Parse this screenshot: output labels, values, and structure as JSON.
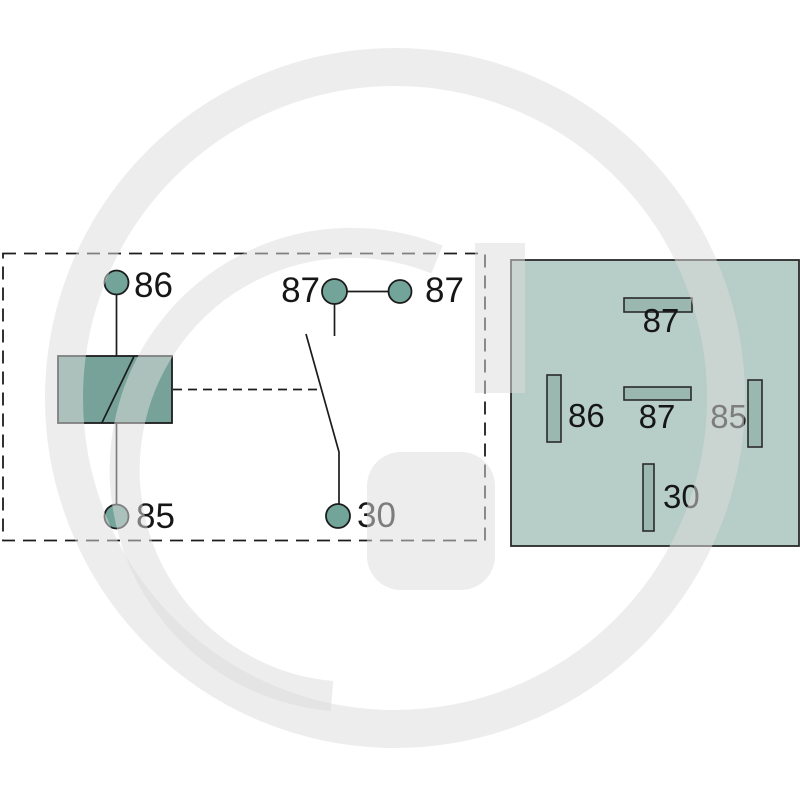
{
  "background_color": "#ffffff",
  "watermark": {
    "description": "large light-gray G logo watermark",
    "color_on_white": "#ededed"
  },
  "schematic": {
    "description": "relay internal circuit schematic inside dashed enclosure",
    "terminals": [
      {
        "id": "86",
        "label": "86"
      },
      {
        "id": "85",
        "label": "85"
      },
      {
        "id": "87-left",
        "label": "87"
      },
      {
        "id": "87-right",
        "label": "87"
      },
      {
        "id": "30",
        "label": "30"
      }
    ]
  },
  "pin_layout": {
    "description": "relay base pin layout (bottom view)",
    "pins": [
      {
        "id": "87-top",
        "label": "87"
      },
      {
        "id": "86-left",
        "label": "86"
      },
      {
        "id": "87-center",
        "label": "87"
      },
      {
        "id": "85-right",
        "label": "85"
      },
      {
        "id": "30-bottom",
        "label": "30"
      }
    ]
  },
  "colors": {
    "terminal_fill": "#73a49a",
    "coil_fill": "#77a299",
    "base_fill": "#b7cdc7",
    "pin_fill": "#9ab8b0",
    "line": "#1c1c1c",
    "text": "#161616"
  }
}
